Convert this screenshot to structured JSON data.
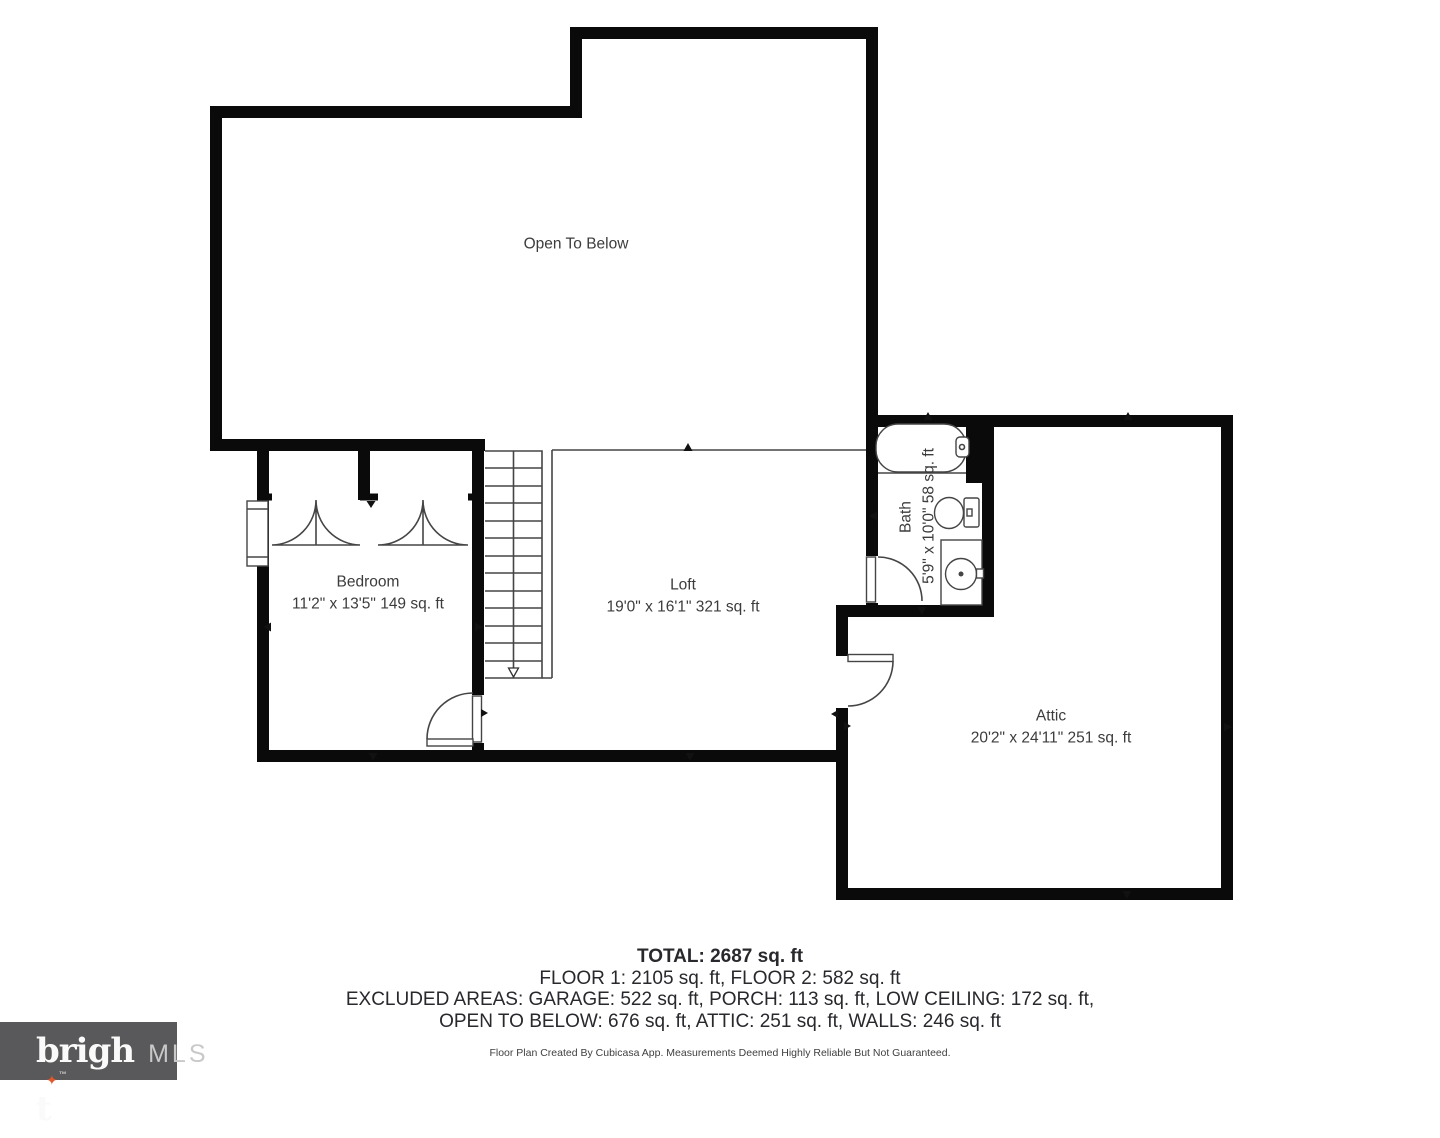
{
  "page": {
    "background": "#ffffff"
  },
  "floor_plan": {
    "rooms": {
      "open_to_below": {
        "label": "Open To Below"
      },
      "bedroom": {
        "label": "Bedroom",
        "dimensions": "11'2\" x 13'5\" 149 sq. ft"
      },
      "loft": {
        "label": "Loft",
        "dimensions": "19'0\" x 16'1\" 321 sq. ft"
      },
      "bath": {
        "label": "Bath",
        "dimensions": "5'9\" x 10'0\" 58 sq. ft"
      },
      "attic": {
        "label": "Attic",
        "dimensions": "20'2\" x 24'11\" 251 sq. ft"
      }
    },
    "colors": {
      "wall": "#0a0a0a",
      "thin_line": "#454545",
      "label_text": "#3c3c3c"
    }
  },
  "summary": {
    "total": "TOTAL: 2687 sq. ft",
    "floors": "FLOOR 1: 2105 sq. ft, FLOOR 2: 582 sq. ft",
    "excluded_line1": "EXCLUDED AREAS: GARAGE: 522 sq. ft, PORCH: 113 sq. ft, LOW CEILING: 172 sq. ft,",
    "excluded_line2": "OPEN TO BELOW: 676 sq. ft, ATTIC: 251 sq. ft, WALLS: 246 sq. ft",
    "disclaimer": "Floor Plan Created By Cubicasa App. Measurements Deemed Highly Reliable But Not Guaranteed.",
    "text_color": "#28282d"
  },
  "logo": {
    "brand_head": "brigh",
    "brand_tail": "t",
    "star_glyph": "✦",
    "trademark": "™",
    "suffix": "MLS",
    "background": "#59585A",
    "brand_color": "#fafafa",
    "suffix_color": "#c9c9c9",
    "star_color": "#E2582A"
  }
}
